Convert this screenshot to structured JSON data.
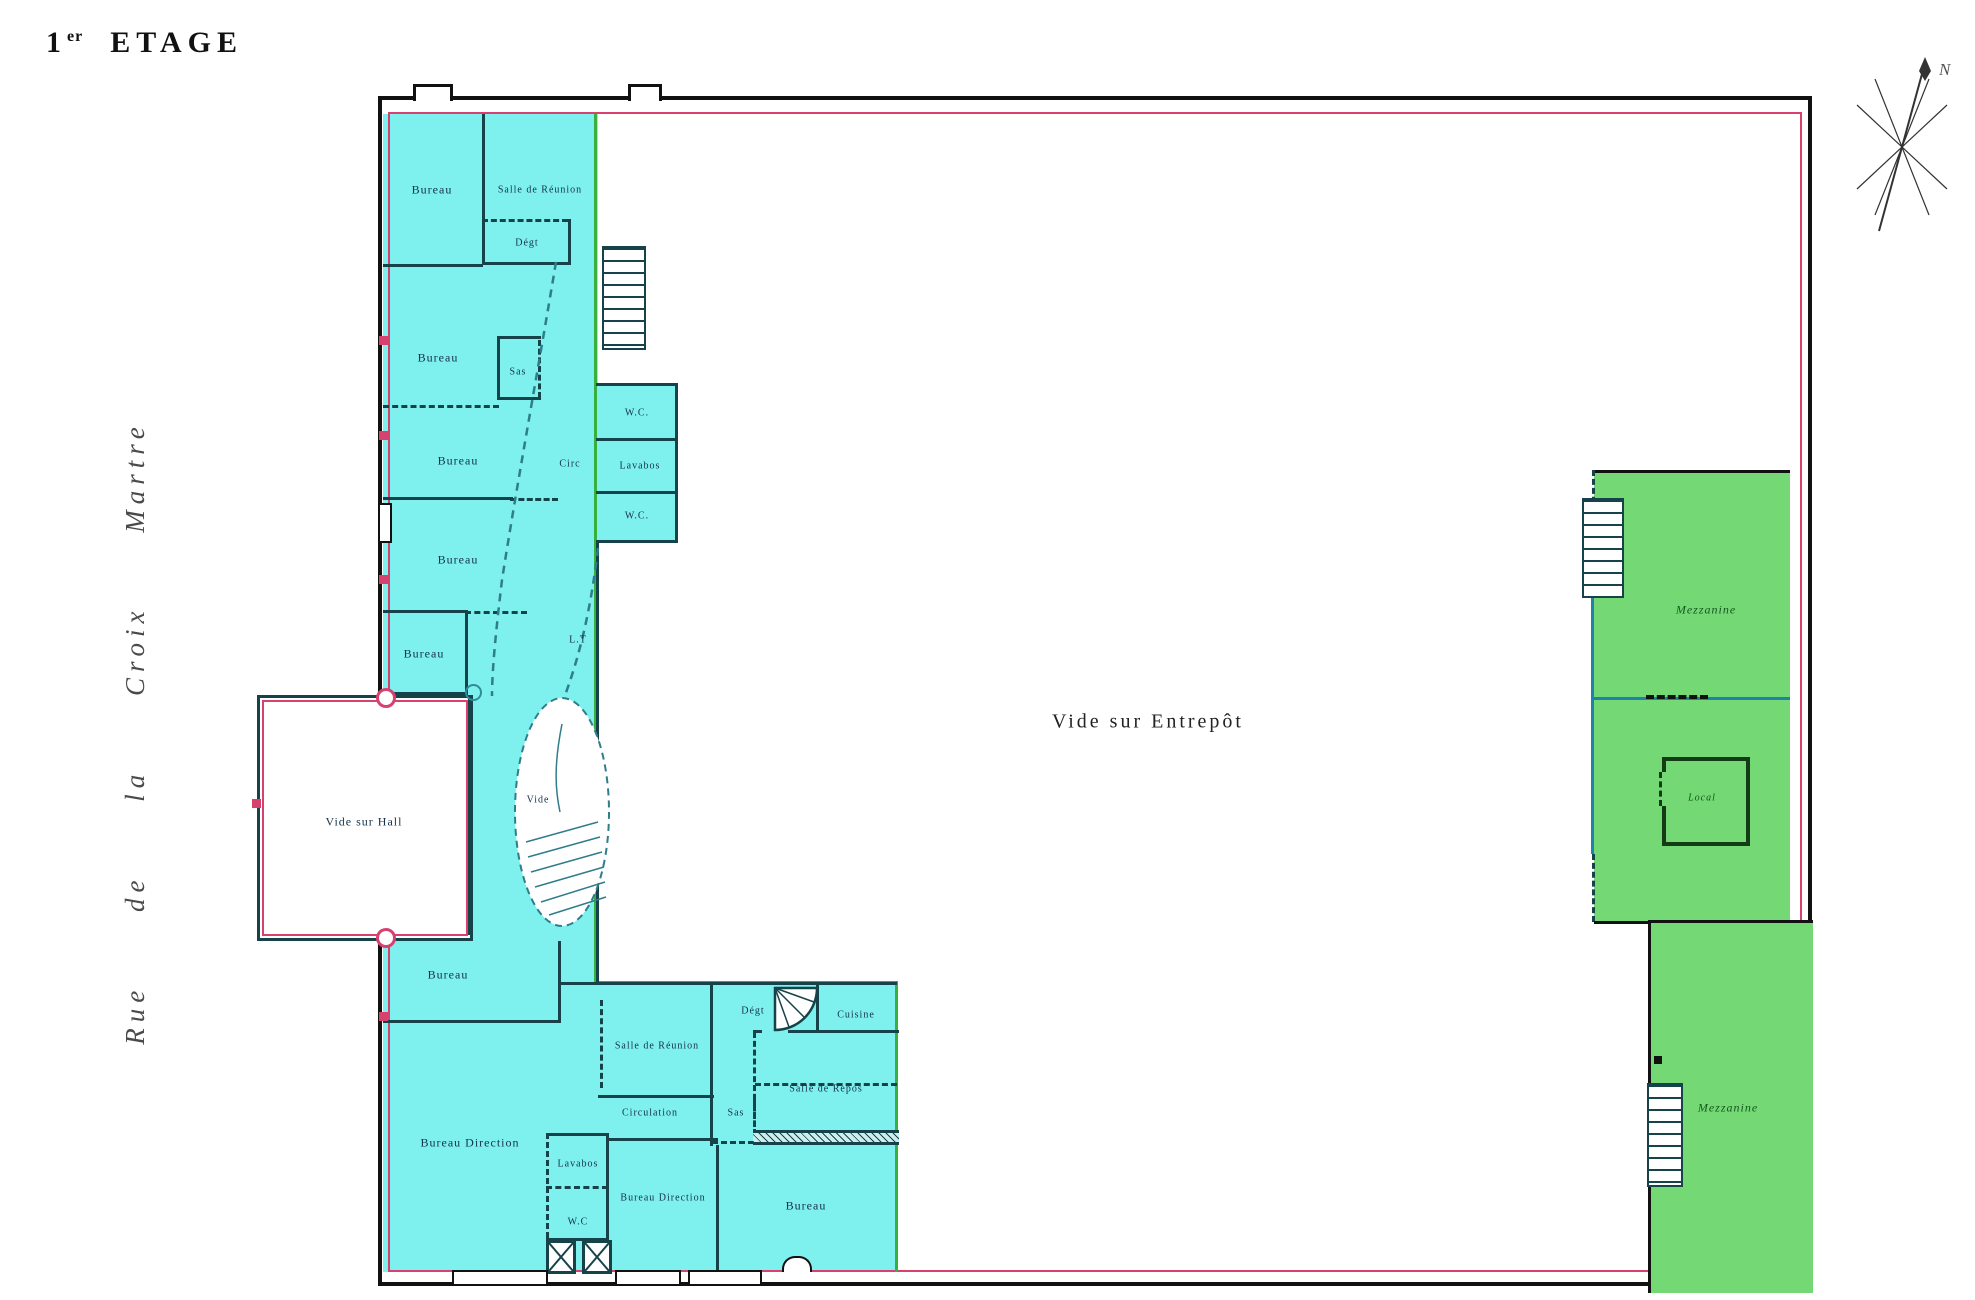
{
  "title": {
    "num": "1",
    "sup": "er",
    "name": "ETAGE"
  },
  "street": "Rue de la Croix Martre",
  "compass": {
    "north": "N"
  },
  "colors": {
    "room_fill": "#7EF0EE",
    "mezzanine_fill": "#74D974",
    "boundary_green": "#38B13C",
    "property_red": "#D8416E",
    "mezzanine_blue": "#1E82AB",
    "wall": "#16424A"
  },
  "labels": [
    {
      "id": "bureau-1",
      "text": "Bureau"
    },
    {
      "id": "salle-reunion-1",
      "text": "Salle de Réunion"
    },
    {
      "id": "degt-1",
      "text": "Dégt"
    },
    {
      "id": "bureau-2",
      "text": "Bureau"
    },
    {
      "id": "sas-1",
      "text": "Sas"
    },
    {
      "id": "bureau-3",
      "text": "Bureau"
    },
    {
      "id": "circ",
      "text": "Circ"
    },
    {
      "id": "wc-1",
      "text": "W.C."
    },
    {
      "id": "lavabos-1",
      "text": "Lavabos"
    },
    {
      "id": "wc-2",
      "text": "W.C."
    },
    {
      "id": "bureau-4",
      "text": "Bureau"
    },
    {
      "id": "bureau-5",
      "text": "Bureau"
    },
    {
      "id": "local-technique",
      "text": "L.T"
    },
    {
      "id": "vide-stair",
      "text": "Vide"
    },
    {
      "id": "vide-sur-hall",
      "text": "Vide sur Hall"
    },
    {
      "id": "bureau-6",
      "text": "Bureau"
    },
    {
      "id": "bureau-direction-1",
      "text": "Bureau Direction"
    },
    {
      "id": "lavabos-2",
      "text": "Lavabos"
    },
    {
      "id": "wc-3",
      "text": "W.C"
    },
    {
      "id": "bureau-direction-2",
      "text": "Bureau Direction"
    },
    {
      "id": "salle-reunion-2",
      "text": "Salle de Réunion"
    },
    {
      "id": "circulation",
      "text": "Circulation"
    },
    {
      "id": "sas-2",
      "text": "Sas"
    },
    {
      "id": "salle-de-repos",
      "text": "Salle de Repos"
    },
    {
      "id": "degt-2",
      "text": "Dégt"
    },
    {
      "id": "cuisine",
      "text": "Cuisine"
    },
    {
      "id": "bureau-7",
      "text": "Bureau"
    },
    {
      "id": "vide-sur-entrepot",
      "text": "Vide sur Entrepôt"
    },
    {
      "id": "mezzanine-1",
      "text": "Mezzanine"
    },
    {
      "id": "local",
      "text": "Local"
    },
    {
      "id": "mezzanine-2",
      "text": "Mezzanine"
    }
  ]
}
